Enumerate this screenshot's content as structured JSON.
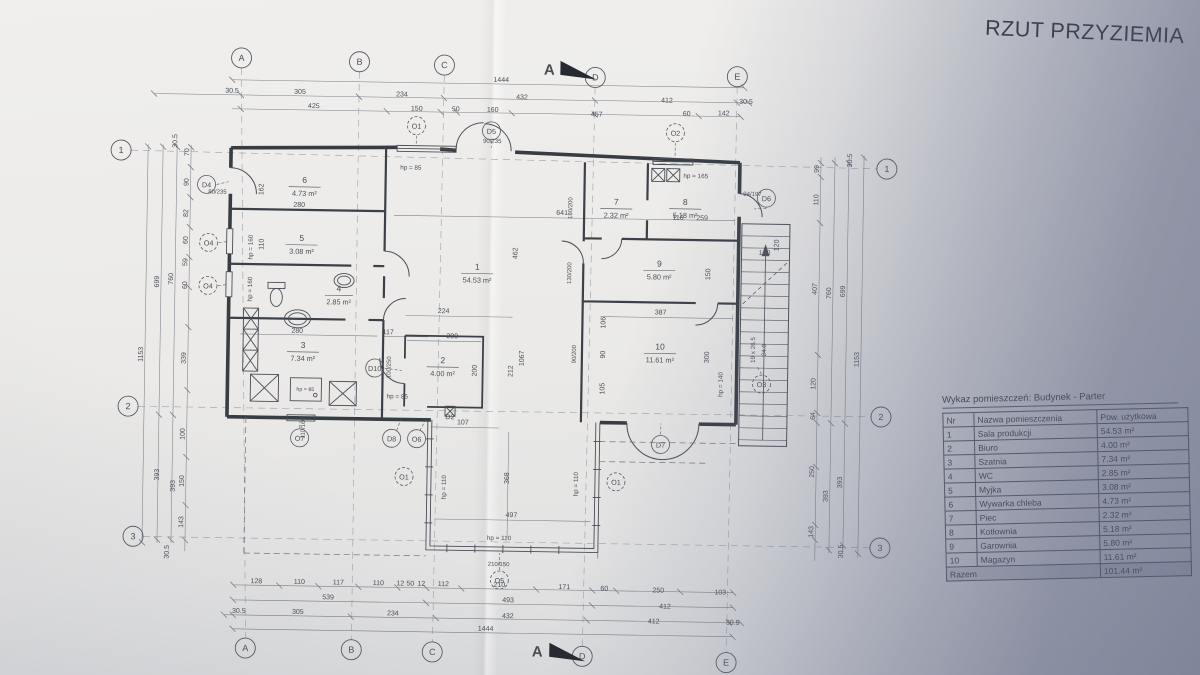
{
  "photo": {
    "paper_color": "#edecea",
    "shadow_color": "#8b92a6",
    "ink_color": "#4a4e55"
  },
  "title": {
    "text": "RZUT PRZYZIEMIA"
  },
  "schedule": {
    "caption": "Wykaz pomieszczeń: Budynek - Parter",
    "col_nr": "Nr",
    "col_name": "Nazwa pomieszczenia",
    "col_area": "Pow. użytkowa",
    "rows": [
      {
        "nr": "1",
        "name": "Sala produkcji",
        "area": "54.53 m²"
      },
      {
        "nr": "2",
        "name": "Biuro",
        "area": "4.00 m²"
      },
      {
        "nr": "3",
        "name": "Szatnia",
        "area": "7.34 m²"
      },
      {
        "nr": "4",
        "name": "WC",
        "area": "2.85 m²"
      },
      {
        "nr": "5",
        "name": "Myjka",
        "area": "3.08 m²"
      },
      {
        "nr": "6",
        "name": "Wywarka chleba",
        "area": "4.73 m²"
      },
      {
        "nr": "7",
        "name": "Piec",
        "area": "2.32 m²"
      },
      {
        "nr": "8",
        "name": "Kotłownia",
        "area": "5.18 m²"
      },
      {
        "nr": "9",
        "name": "Garownia",
        "area": "5.80 m²"
      },
      {
        "nr": "10",
        "name": "Magazyn",
        "area": "11.61 m²"
      }
    ],
    "total_label": "Razem",
    "total_area": "101.44 m²"
  },
  "plan": {
    "grid_cols": [
      "A",
      "B",
      "C",
      "D",
      "E"
    ],
    "grid_rows": [
      "1",
      "2",
      "3"
    ],
    "section_label": "A",
    "rooms": [
      {
        "nr": "1",
        "area": "54.53 m²"
      },
      {
        "nr": "2",
        "area": "4.00 m²"
      },
      {
        "nr": "3",
        "area": "7.34 m²"
      },
      {
        "nr": "4",
        "area": "2.85 m²"
      },
      {
        "nr": "5",
        "area": "3.08 m²"
      },
      {
        "nr": "6",
        "area": "4.73 m²"
      },
      {
        "nr": "7",
        "area": "2.32 m²"
      },
      {
        "nr": "8",
        "area": "5.18 m²"
      },
      {
        "nr": "9",
        "area": "5.80 m²"
      },
      {
        "nr": "10",
        "area": "11.61 m²"
      }
    ],
    "dim_top": [
      "1444",
      "30.5",
      "305",
      "234",
      "432",
      "412",
      "30.5",
      "425",
      "150",
      "50",
      "160",
      "457",
      "60",
      "142"
    ],
    "dim_bottom": [
      "128",
      "110",
      "117",
      "110",
      "12",
      "50",
      "12",
      "112",
      "210",
      "171",
      "60",
      "250",
      "103",
      "539",
      "493",
      "412",
      "30.5",
      "305",
      "234",
      "432",
      "412",
      "30.5",
      "1444"
    ],
    "dim_left": [
      "70",
      "90",
      "82",
      "60",
      "59",
      "60",
      "339",
      "100",
      "150",
      "143",
      "699",
      "393",
      "760",
      "393",
      "1153",
      "30.5",
      "30.5"
    ],
    "dim_right": [
      "99",
      "110",
      "407",
      "120",
      "64",
      "250",
      "143",
      "760",
      "393",
      "699",
      "393",
      "1153",
      "30.5",
      "30.5"
    ],
    "dim_inner": [
      "162",
      "280",
      "110",
      "280",
      "117",
      "641",
      "462",
      "224",
      "200",
      "200",
      "107",
      "212",
      "1067",
      "116",
      "259",
      "150",
      "387",
      "106",
      "90",
      "105",
      "300",
      "368",
      "497",
      "120",
      "120"
    ],
    "door_specs": [
      "80/235",
      "90/235",
      "94/197",
      "180/200",
      "130/200",
      "90/200",
      "100/250",
      "110/160",
      "210/150"
    ],
    "annotations": {
      "hp85": "hp = 85",
      "hp110": "hp = 110",
      "hp140": "hp = 140",
      "hp160": "hp = 160",
      "hp165": "hp = 165",
      "stair_steps": "19 x 26.5",
      "stair_width": "24.0"
    },
    "markers": [
      "O1",
      "D5",
      "O2",
      "D4",
      "O4",
      "O4",
      "D10",
      "O7",
      "D8",
      "O6",
      "D7",
      "O5",
      "O3",
      "D6",
      "D2",
      "O1",
      "O1"
    ]
  }
}
